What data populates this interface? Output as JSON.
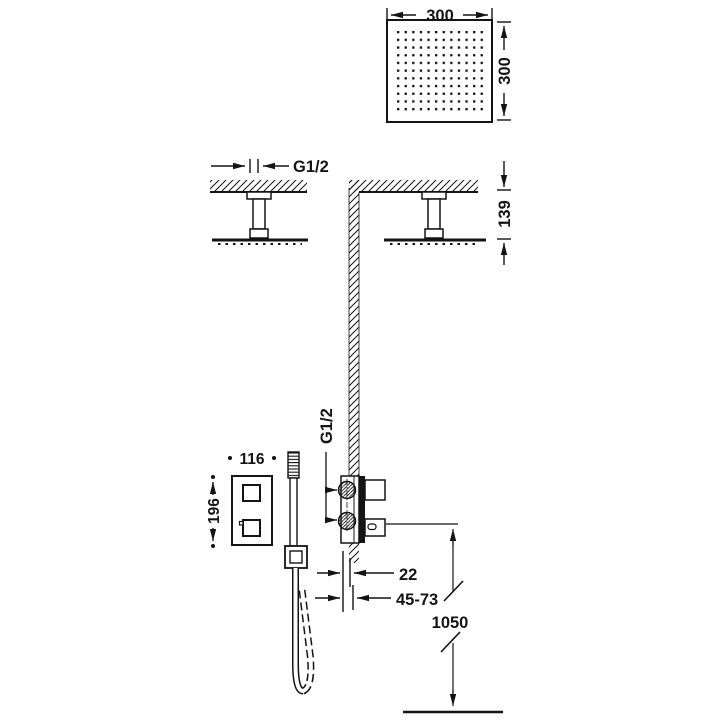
{
  "drawing": {
    "title": "shower-system-installation-dimensions",
    "line_color": "#141414",
    "background_color": "#ffffff",
    "labels": {
      "head_width": "300",
      "head_depth": "300",
      "ceiling_thread": "G1/2",
      "head_drop": "139",
      "valve_thread": "G1/2",
      "valve_plate_width": "116",
      "valve_plate_height": "196",
      "trim_depth": "22",
      "rough_in_range": "45-73",
      "outlet_height": "1050"
    }
  }
}
